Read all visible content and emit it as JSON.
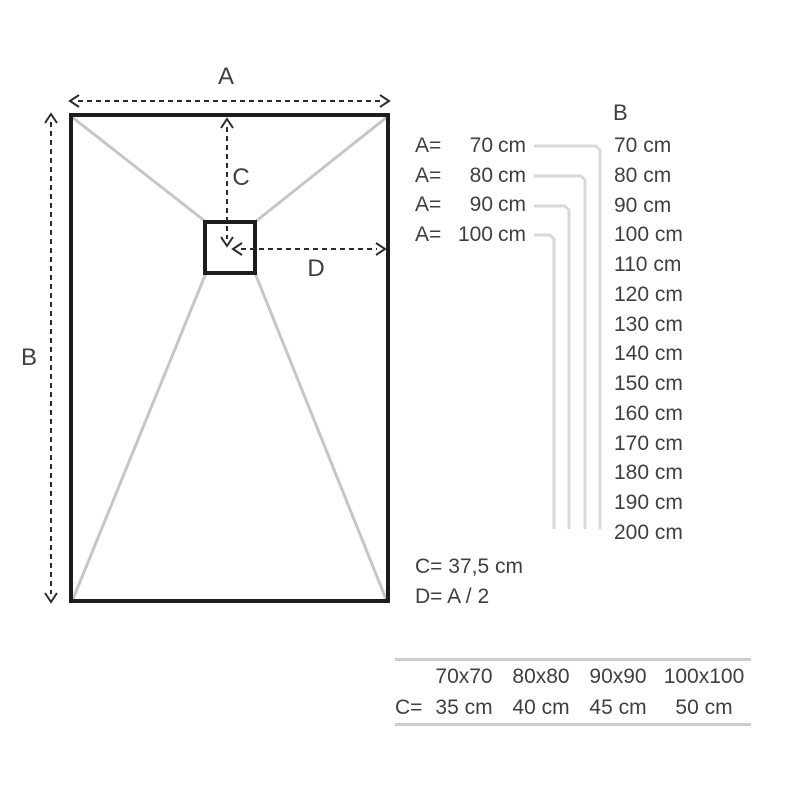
{
  "page": {
    "background": "#ffffff"
  },
  "diagram": {
    "label_a": "A",
    "label_b": "B",
    "label_c": "C",
    "label_d": "D",
    "colors": {
      "outline": "#1d1d1d",
      "diagonal_gray": "#c6c6c6",
      "bracket_gray": "#d9d9d9",
      "arrow": "#2b2b2b",
      "text": "#3f3f3f",
      "rule_gray": "#cccccc"
    }
  },
  "legend": {
    "b_header": "B",
    "a_rows": [
      {
        "label": "A=",
        "value": "70",
        "unit": "cm"
      },
      {
        "label": "A=",
        "value": "80",
        "unit": "cm"
      },
      {
        "label": "A=",
        "value": "90",
        "unit": "cm"
      },
      {
        "label": "A=",
        "value": "100",
        "unit": "cm"
      }
    ],
    "b_values": [
      "70 cm",
      "80 cm",
      "90 cm",
      "100 cm",
      "110 cm",
      "120 cm",
      "130 cm",
      "140 cm",
      "150 cm",
      "160 cm",
      "170 cm",
      "180 cm",
      "190 cm",
      "200 cm"
    ],
    "c_note": "C= 37,5 cm",
    "d_note": "D= A / 2"
  },
  "size_table": {
    "row_label": "C=",
    "columns": [
      "70x70",
      "80x80",
      "90x90",
      "100x100"
    ],
    "values": [
      "35 cm",
      "40 cm",
      "45 cm",
      "50 cm"
    ]
  }
}
